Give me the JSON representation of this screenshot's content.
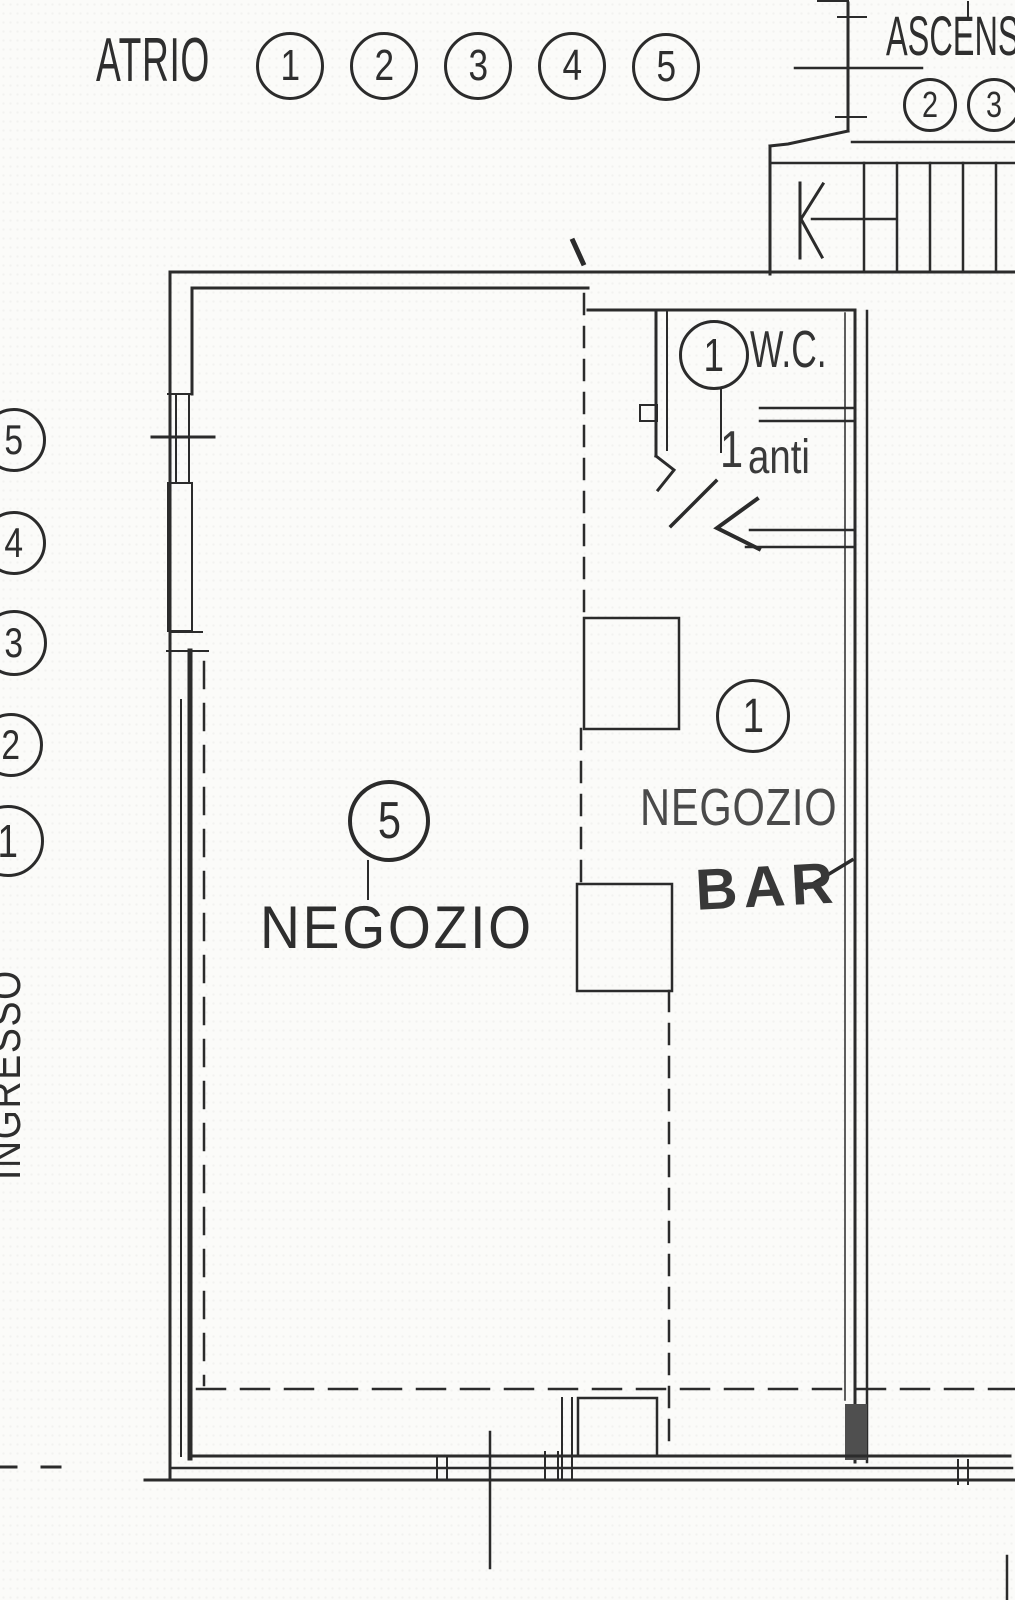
{
  "canvas": {
    "width": 1015,
    "height": 1600
  },
  "colors": {
    "line": "#2b2b2b",
    "background": "#fbfbf9"
  },
  "atrio": {
    "label": "ATRIO",
    "units": [
      "1",
      "2",
      "3",
      "4",
      "5"
    ]
  },
  "elevator": {
    "label": "ASCENS",
    "units": [
      "2",
      "3"
    ]
  },
  "wc": {
    "unit": "1",
    "label": "W.C.",
    "anti_number": "1",
    "anti_label": "anti"
  },
  "shop_5": {
    "unit": "5",
    "label": "NEGOZIO"
  },
  "shop_1": {
    "unit": "1",
    "label": "NEGOZIO",
    "handwritten": "BAR"
  },
  "entrance": {
    "label": "INGRESSO",
    "units": [
      "5",
      "4",
      "3",
      "2",
      "1"
    ]
  }
}
